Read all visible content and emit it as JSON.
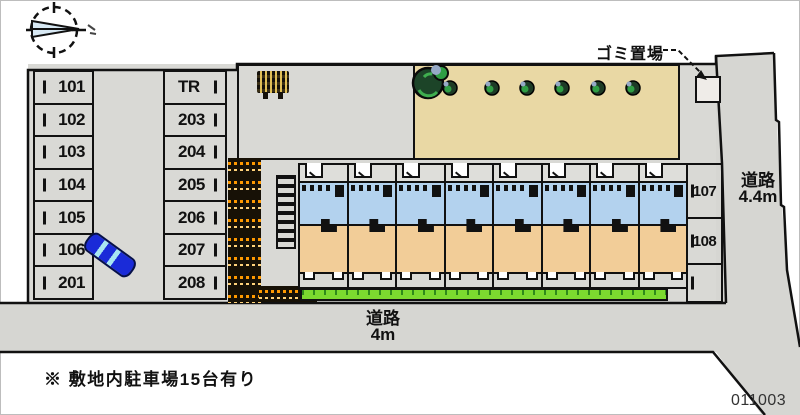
{
  "map": {
    "garbage_label": "ゴミ置場",
    "road_right": {
      "name": "道路",
      "width": "4.4m"
    },
    "road_bottom": {
      "name": "道路",
      "width": "4m"
    },
    "note": "※ 敷地内駐車場15台有り",
    "plan_number": "011003",
    "parking": {
      "column_left": [
        "101",
        "102",
        "103",
        "104",
        "105",
        "106",
        "201"
      ],
      "column_middle": [
        "TR",
        "203",
        "204",
        "205",
        "206",
        "207",
        "208"
      ],
      "column_right": [
        "107",
        "108"
      ]
    },
    "building_units": 8
  },
  "icons": {
    "compass": "compass-rose-pointing-right",
    "tree": "round-shrub",
    "car": "parked-car-top-view",
    "bicycle_area": "bicycle-parking-dots",
    "stairs": "exterior-staircase",
    "signboard": "notice-board"
  },
  "colors": {
    "room_tan": "#f2cd98",
    "wet_area_blue": "#b3d2ee",
    "lawn_green": "#7cd92f",
    "garden_beige": "#e9d8a4",
    "pavement_gray": "#d9d9d5",
    "road_gray": "#d6d6d2",
    "car_blue": "#1a2bd8",
    "bike_orange": "#ff9900",
    "line_black": "#111111"
  }
}
